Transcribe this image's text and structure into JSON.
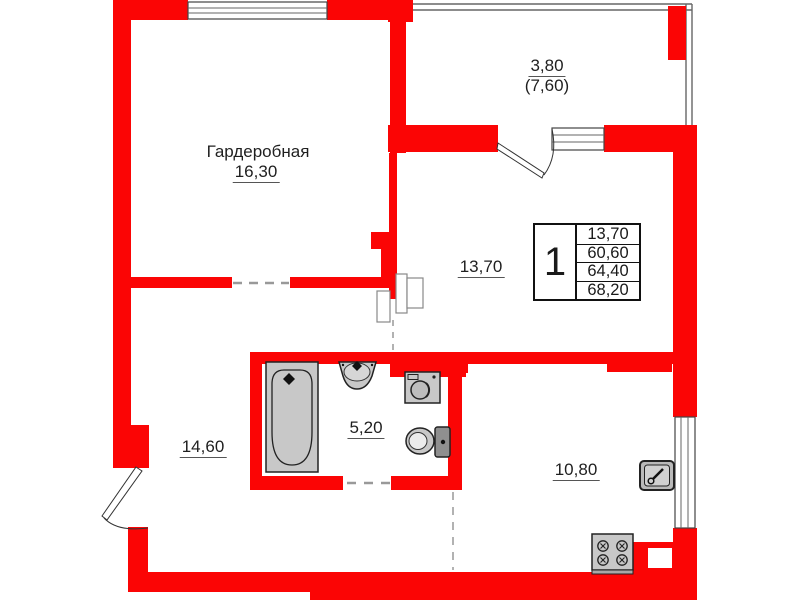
{
  "meta": {
    "type": "apartment-floor-plan",
    "units": "m2"
  },
  "colors": {
    "wall": "#fb0505",
    "fixture_fill": "#c8c8c8",
    "fixture_stroke": "#222222",
    "dash": "#999999",
    "text": "#1f1f1f"
  },
  "labels": {
    "wardrobe_name": "Гардеробная",
    "wardrobe_area": "16,30",
    "balcony_area": "3,80",
    "balcony_area_total": "(7,60)",
    "living_area": "13,70",
    "bathroom_area": "5,20",
    "hall_area": "14,60",
    "kitchen_area": "10,80"
  },
  "info_table": {
    "rooms_count": "1",
    "values": [
      "13,70",
      "60,60",
      "64,40",
      "68,20"
    ]
  },
  "fixtures": [
    "bathtub-icon",
    "bathroom-sink-icon",
    "washing-machine-icon",
    "toilet-icon",
    "kitchen-sink-icon",
    "stove-icon"
  ]
}
